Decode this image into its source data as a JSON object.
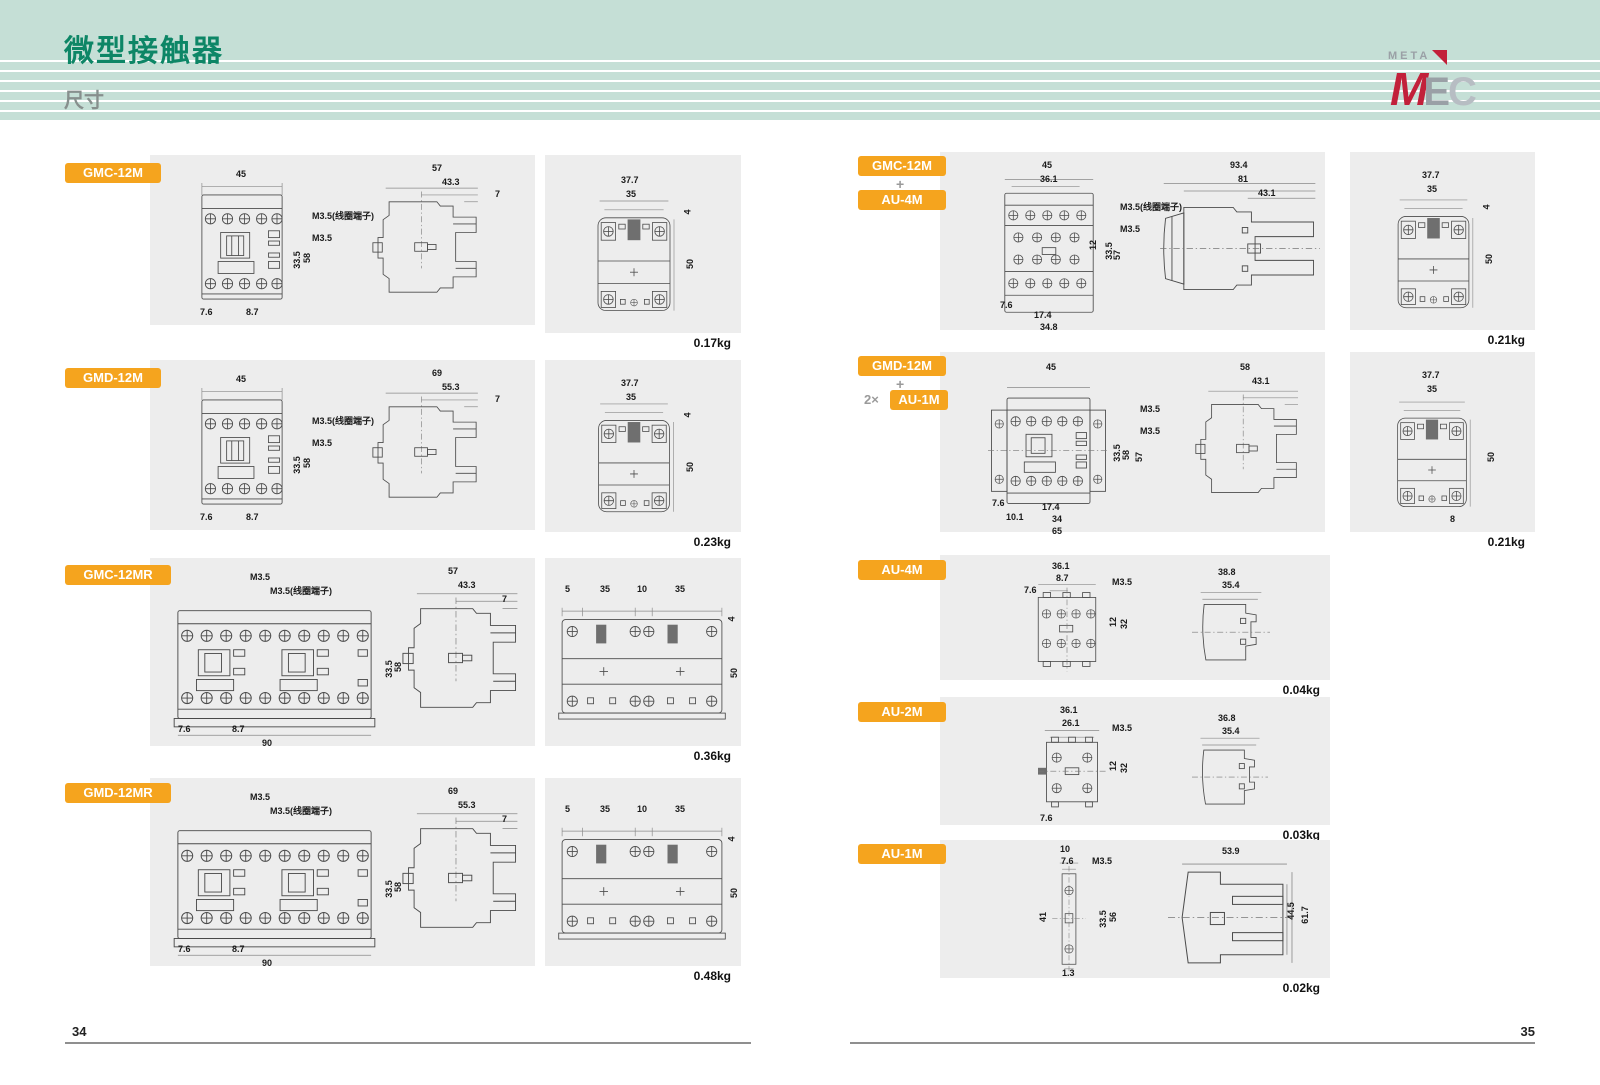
{
  "header": {
    "title": "微型接触器",
    "subtitle": "尺寸",
    "logo": {
      "meta": "META",
      "m": "M",
      "e": "E",
      "c": "C"
    }
  },
  "footer": {
    "left_page": "34",
    "right_page": "35"
  },
  "sections": {
    "l1": {
      "badge": "GMC-12M",
      "weight": "0.17kg",
      "front": {
        "w1": "45",
        "note1": "M3.5(线圈端子)",
        "note2": "M3.5",
        "h1": "33.5",
        "h2": "58",
        "b1": "7.6",
        "b2": "8.7"
      },
      "side": {
        "d1": "57",
        "d2": "43.3",
        "d3": "7"
      },
      "rear": {
        "w1": "37.7",
        "w2": "35",
        "r1": "4",
        "r2": "50"
      }
    },
    "l2": {
      "badge": "GMD-12M",
      "weight": "0.23kg",
      "front": {
        "w1": "45",
        "note1": "M3.5(线圈端子)",
        "note2": "M3.5",
        "h1": "33.5",
        "h2": "58",
        "b1": "7.6",
        "b2": "8.7"
      },
      "side": {
        "d1": "69",
        "d2": "55.3",
        "d3": "7"
      },
      "rear": {
        "w1": "37.7",
        "w2": "35",
        "r1": "4",
        "r2": "50"
      }
    },
    "l3": {
      "badge": "GMC-12MR",
      "weight": "0.36kg",
      "front": {
        "note1": "M3.5",
        "note2": "M3.5(线圈端子)",
        "h1": "33.5",
        "h2": "58",
        "b1": "7.6",
        "b2": "8.7",
        "b3": "90"
      },
      "side": {
        "d1": "57",
        "d2": "43.3",
        "d3": "7"
      },
      "rear": {
        "t1": "5",
        "t2": "35",
        "t3": "10",
        "t4": "35",
        "r1": "4",
        "r2": "50"
      }
    },
    "l4": {
      "badge": "GMD-12MR",
      "weight": "0.48kg",
      "front": {
        "note1": "M3.5",
        "note2": "M3.5(线圈端子)",
        "h1": "33.5",
        "h2": "58",
        "b1": "7.6",
        "b2": "8.7",
        "b3": "90"
      },
      "side": {
        "d1": "69",
        "d2": "55.3",
        "d3": "7"
      },
      "rear": {
        "t1": "5",
        "t2": "35",
        "t3": "10",
        "t4": "35",
        "r1": "4",
        "r2": "50"
      }
    },
    "r1": {
      "badge1": "GMC-12M",
      "plus": "+",
      "badge2": "AU-4M",
      "weight": "0.21kg",
      "front": {
        "w1": "45",
        "w2": "36.1",
        "note1": "M3.5(线圈端子)",
        "note2": "M3.5",
        "h1": "12",
        "h2": "33.5",
        "h3": "57",
        "b1": "7.6",
        "b2": "17.4",
        "b3": "34.8"
      },
      "side": {
        "d1": "93.4",
        "d2": "81",
        "d3": "43.1"
      },
      "rear": {
        "w1": "37.7",
        "w2": "35",
        "r1": "4",
        "r2": "50"
      }
    },
    "r2": {
      "badge1": "GMD-12M",
      "plus": "+",
      "mult": "2×",
      "badge2": "AU-1M",
      "weight": "0.21kg",
      "front": {
        "w1": "45",
        "note1": "M3.5",
        "note2": "M3.5",
        "h1": "33.5",
        "h2": "58",
        "h3": "57",
        "b1": "7.6",
        "b2": "10.1",
        "b3": "17.4",
        "b4": "34",
        "b5": "65"
      },
      "side": {
        "d1": "58",
        "d2": "43.1"
      },
      "rear": {
        "w1": "37.7",
        "w2": "35",
        "r1": "50",
        "b1": "8"
      }
    },
    "r3": {
      "badge": "AU-4M",
      "weight": "0.04kg",
      "front": {
        "w1": "36.1",
        "w2": "8.7",
        "l1": "7.6",
        "note": "M3.5",
        "h1": "12",
        "h2": "32"
      },
      "side": {
        "d1": "38.8",
        "d2": "35.4"
      }
    },
    "r4": {
      "badge": "AU-2M",
      "weight": "0.03kg",
      "front": {
        "w1": "36.1",
        "w2": "26.1",
        "note": "M3.5",
        "h1": "12",
        "h2": "32",
        "b1": "7.6"
      },
      "side": {
        "d1": "36.8",
        "d2": "35.4"
      }
    },
    "r5": {
      "badge": "AU-1M",
      "weight": "0.02kg",
      "front": {
        "w1": "10",
        "w2": "7.6",
        "note": "M3.5",
        "l1": "41",
        "h1": "33.5",
        "h2": "56",
        "b1": "1.3"
      },
      "side": {
        "d1": "53.9",
        "r1": "44.5",
        "r2": "61.7"
      }
    }
  }
}
